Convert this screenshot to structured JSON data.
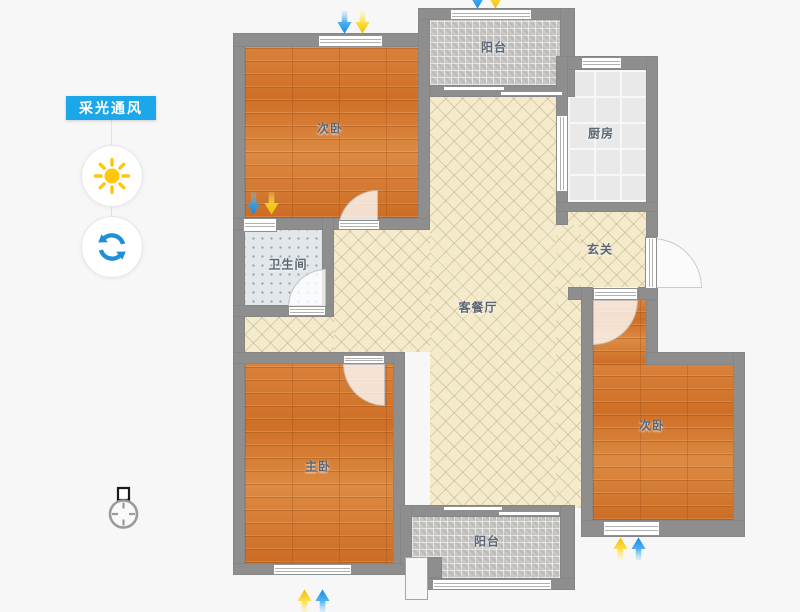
{
  "panel": {
    "title": "采光通风"
  },
  "rooms": [
    {
      "id": "bedroom-top-left",
      "label": "次卧"
    },
    {
      "id": "balcony-top",
      "label": "阳台"
    },
    {
      "id": "kitchen",
      "label": "厨房"
    },
    {
      "id": "entry-hall",
      "label": "玄关"
    },
    {
      "id": "bathroom",
      "label": "卫生间"
    },
    {
      "id": "living-dining",
      "label": "客餐厅"
    },
    {
      "id": "master-bedroom",
      "label": "主卧"
    },
    {
      "id": "bedroom-right",
      "label": "次卧"
    },
    {
      "id": "balcony-bottom",
      "label": "阳台"
    }
  ],
  "icons": {
    "sun": "sun-icon",
    "refresh": "refresh-icon",
    "compass": "compass-icon",
    "wind_arrow": "wind-arrow",
    "daylight_arrow": "daylight-arrow"
  },
  "colors": {
    "accent_blue": "#1ba7e9",
    "sun_yellow": "#ffc60a",
    "refresh_blue": "#1f8fd8",
    "wind_arrow_blue": "#0d8ce8",
    "daylight_arrow_yellow": "#ffd312",
    "wall_gray": "#8e8e8e",
    "wood_floor": "#d4762e",
    "living_floor": "#f4ebcd",
    "balcony_tile": "#c9c7c4",
    "kitchen_tile": "#e9e9e9",
    "bathroom_tile": "#e2e7ea"
  }
}
